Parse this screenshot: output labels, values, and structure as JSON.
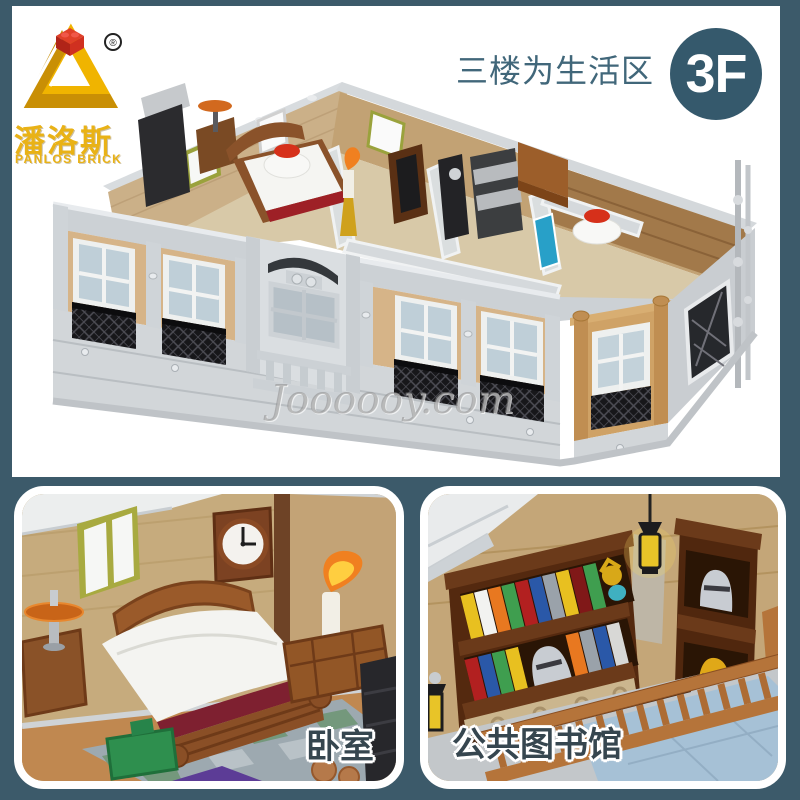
{
  "theme": {
    "background": "#3c5a6a",
    "panel": "#ffffff"
  },
  "brand": {
    "name_cn": "潘洛斯",
    "name_en": "PANLOS BRICK",
    "registered_mark": "®",
    "logo_icon": "penrose-triangle-with-red-brick",
    "logo_color": "#e9b216",
    "brick_color": "#d63a20"
  },
  "header": {
    "caption": "三楼为生活区",
    "caption_color": "#41677a",
    "floor_badge": {
      "label": "3F",
      "background": "#35596c",
      "color": "#ffffff"
    }
  },
  "main_image": {
    "subject": "brick-built third-floor living area model, roofless isometric view",
    "watermark": "Joooooy.com",
    "colors": {
      "wall_gray": "#ced3d7",
      "facade_tan": "#d6b488",
      "interior_tan": "#cbb088",
      "lattice_black": "#17171a",
      "accent_red": "#d6301a"
    }
  },
  "gallery": {
    "items": [
      {
        "label": "卧室"
      },
      {
        "label": "公共图书馆"
      }
    ],
    "label_color": "#36464f",
    "label_outline": "#ffffff"
  }
}
